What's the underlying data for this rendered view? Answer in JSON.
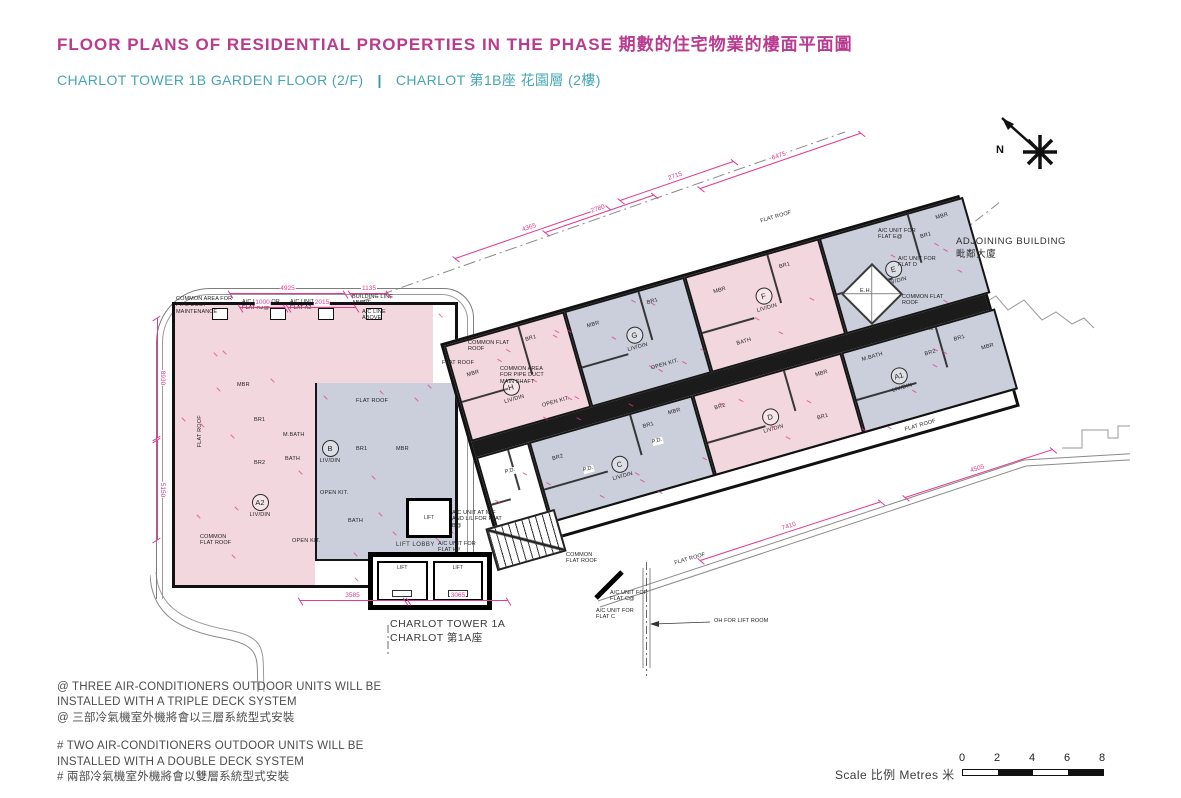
{
  "header": {
    "title": "FLOOR PLANS OF RESIDENTIAL PROPERTIES IN THE PHASE 期數的住宅物業的樓面平面圖",
    "subtitle_en": "CHARLOT TOWER 1B  GARDEN FLOOR (2/F)",
    "subtitle_divider": "|",
    "subtitle_zh": "CHARLOT 第1B座 花園層 (2樓)"
  },
  "plan": {
    "north_label": "N",
    "adjoining_building_en": "ADJOINING BUILDING",
    "adjoining_building_zh": "毗鄰大廈",
    "tower_1a_en": "CHARLOT TOWER 1A",
    "tower_1a_zh": "CHARLOT 第1A座",
    "lift_lobby": "LIFT LOBBY",
    "lift": "LIFT",
    "eh": "E.H.",
    "emr": "EMR",
    "pd": "P.D.",
    "units": [
      {
        "id": "A2",
        "living": "LIV/DIN",
        "rooms": [
          "MBR",
          "BR1",
          "BR2",
          "M.BATH",
          "BATH",
          "OPEN KIT."
        ]
      },
      {
        "id": "B",
        "living": "LIV/DIN",
        "rooms": [
          "BR1",
          "MBR",
          "OPEN KIT.",
          "BATH"
        ]
      },
      {
        "id": "H",
        "living": "LIV/DIN",
        "rooms": [
          "BR1",
          "MBR",
          "OPEN KIT."
        ]
      },
      {
        "id": "G",
        "living": "LIV/DIN",
        "rooms": [
          "BR1",
          "MBR",
          "OPEN KIT."
        ]
      },
      {
        "id": "F",
        "living": "LIV/DIN",
        "rooms": [
          "BR1",
          "MBR",
          "BATH"
        ]
      },
      {
        "id": "E",
        "living": "LIV/DIN",
        "rooms": [
          "BR1",
          "MBR",
          "BATH"
        ]
      },
      {
        "id": "C",
        "living": "LIV/DIN",
        "rooms": [
          "BR1",
          "BR2",
          "MBR"
        ]
      },
      {
        "id": "D",
        "living": "LIV/DIN",
        "rooms": [
          "BR1",
          "BR2",
          "MBR"
        ]
      },
      {
        "id": "A1",
        "living": "LIV/DIN",
        "rooms": [
          "BR2",
          "BR1",
          "MBR",
          "M.BATH"
        ]
      }
    ],
    "area_labels": [
      "FLAT ROOF",
      "FLAT ROOF",
      "FLAT ROOF",
      "FLAT ROOF",
      "FLAT ROOF",
      "FLAT ROOF"
    ],
    "annotations": [
      "COMMON AREA FOR PIPE DUCT MAINTENANCE",
      "A/C UNIT FOR FLAT A2@",
      "A/C UNIT FOR FLAT A2",
      "BUILDING LINE ABOVE",
      "A/C LINE ABOVE",
      "COMMON FLAT ROOF",
      "COMMON AREA FOR PIPE DUCT MAIN SHAFT",
      "A/C UNIT AT M/F AND L/L FOR FLAT B@",
      "A/C UNIT FOR FLAT H#",
      "A/C UNIT FOR FLAT C@",
      "A/C UNIT FOR FLAT C",
      "A/C UNIT FOR FLAT E@",
      "A/C UNIT FOR FLAT D",
      "COMMON FLAT ROOF",
      "A/C UNIT FOR FLAT A1",
      "COMMON FLAT ROOF",
      "COMMON FLAT ROOF",
      "OH FOR LIFT ROOM"
    ],
    "dimensions": [
      "4925",
      "1135",
      "8930",
      "5150",
      "4365",
      "2715",
      "6475",
      "2780",
      "3585",
      "3065",
      "7410",
      "4505",
      "1000",
      "2015"
    ]
  },
  "notes": [
    {
      "lines": [
        "@ THREE AIR-CONDITIONERS OUTDOOR UNITS WILL BE",
        "INSTALLED WITH A TRIPLE DECK SYSTEM",
        "@ 三部冷氣機室外機將會以三層系統型式安裝"
      ]
    },
    {
      "lines": [
        "# TWO AIR-CONDITIONERS OUTDOOR UNITS WILL BE",
        "INSTALLED WITH A DOUBLE DECK SYSTEM",
        "# 兩部冷氣機室外機將會以雙層系統型式安裝"
      ]
    }
  ],
  "scale": {
    "label_en": "Scale",
    "label_zh": "比例",
    "unit_en": "Metres",
    "unit_zh": "米",
    "ticks": [
      "0",
      "2",
      "4",
      "6",
      "8"
    ]
  },
  "colors": {
    "title": "#b93b8f",
    "subtitle": "#46a5b5",
    "dimension": "#e23a92",
    "unit_pink": "#f2d7de",
    "unit_gray": "#cbcedb",
    "wall": "#161616"
  }
}
